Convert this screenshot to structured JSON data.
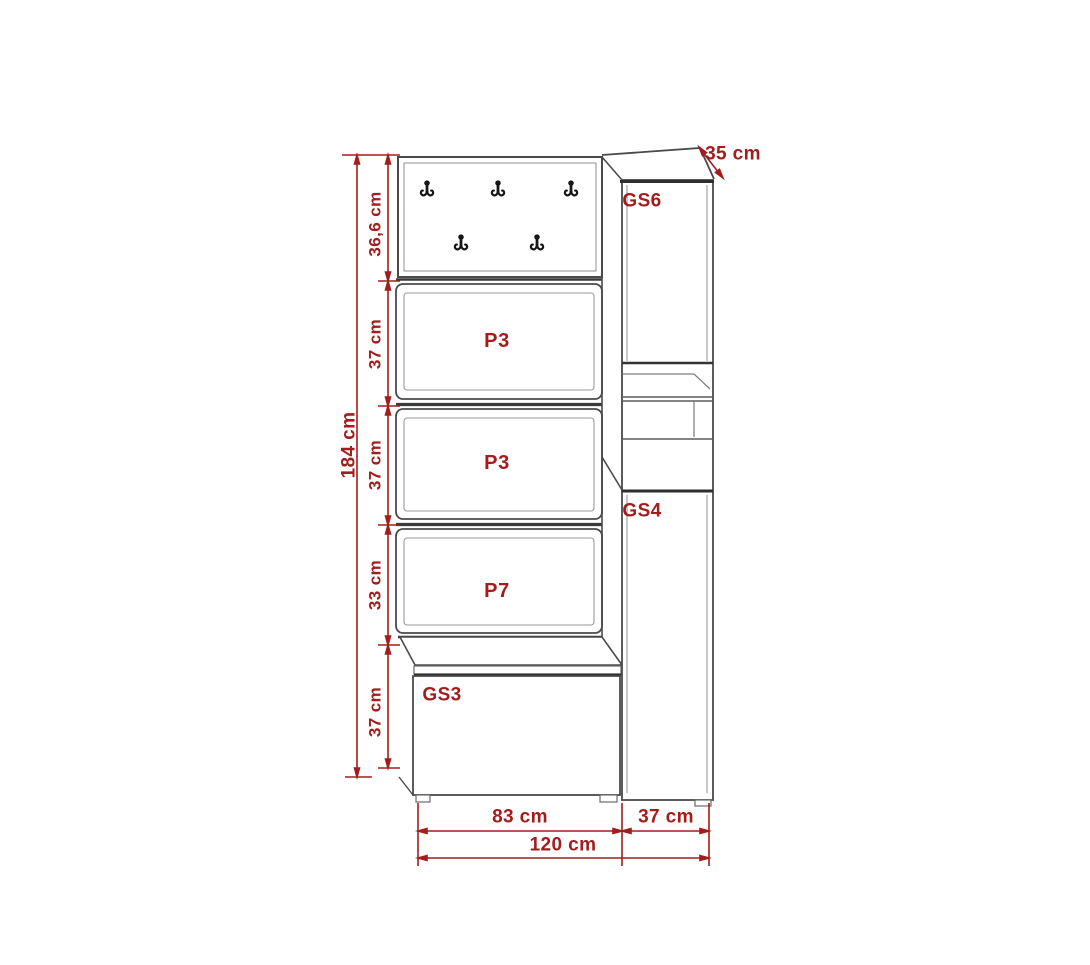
{
  "meta": {
    "title": "Hallway furniture set dimension drawing",
    "units": "cm"
  },
  "colors": {
    "dimension_red": "#a31d1d",
    "outline_gray": "#4a4a4a",
    "inner_line_gray": "#9a9a9a",
    "background": "#ffffff"
  },
  "labels": {
    "depth_top": "35 cm",
    "height_total": "184 cm",
    "seg_hook_panel": "36,6 cm",
    "seg_shelf_1": "37 cm",
    "seg_shelf_2": "37 cm",
    "seg_shelf_3": "33 cm",
    "seg_bench": "37 cm",
    "width_left": "83 cm",
    "width_right": "37 cm",
    "width_total": "120 cm",
    "part_gs6": "GS6",
    "part_gs4": "GS4",
    "part_gs3": "GS3",
    "panel_p3_top": "P3",
    "panel_p3_middle": "P3",
    "panel_p7": "P7"
  },
  "icons": {
    "coat_hook": {
      "name": "coat-hook-icon",
      "glyph": "double coat hook",
      "count": 5
    }
  }
}
